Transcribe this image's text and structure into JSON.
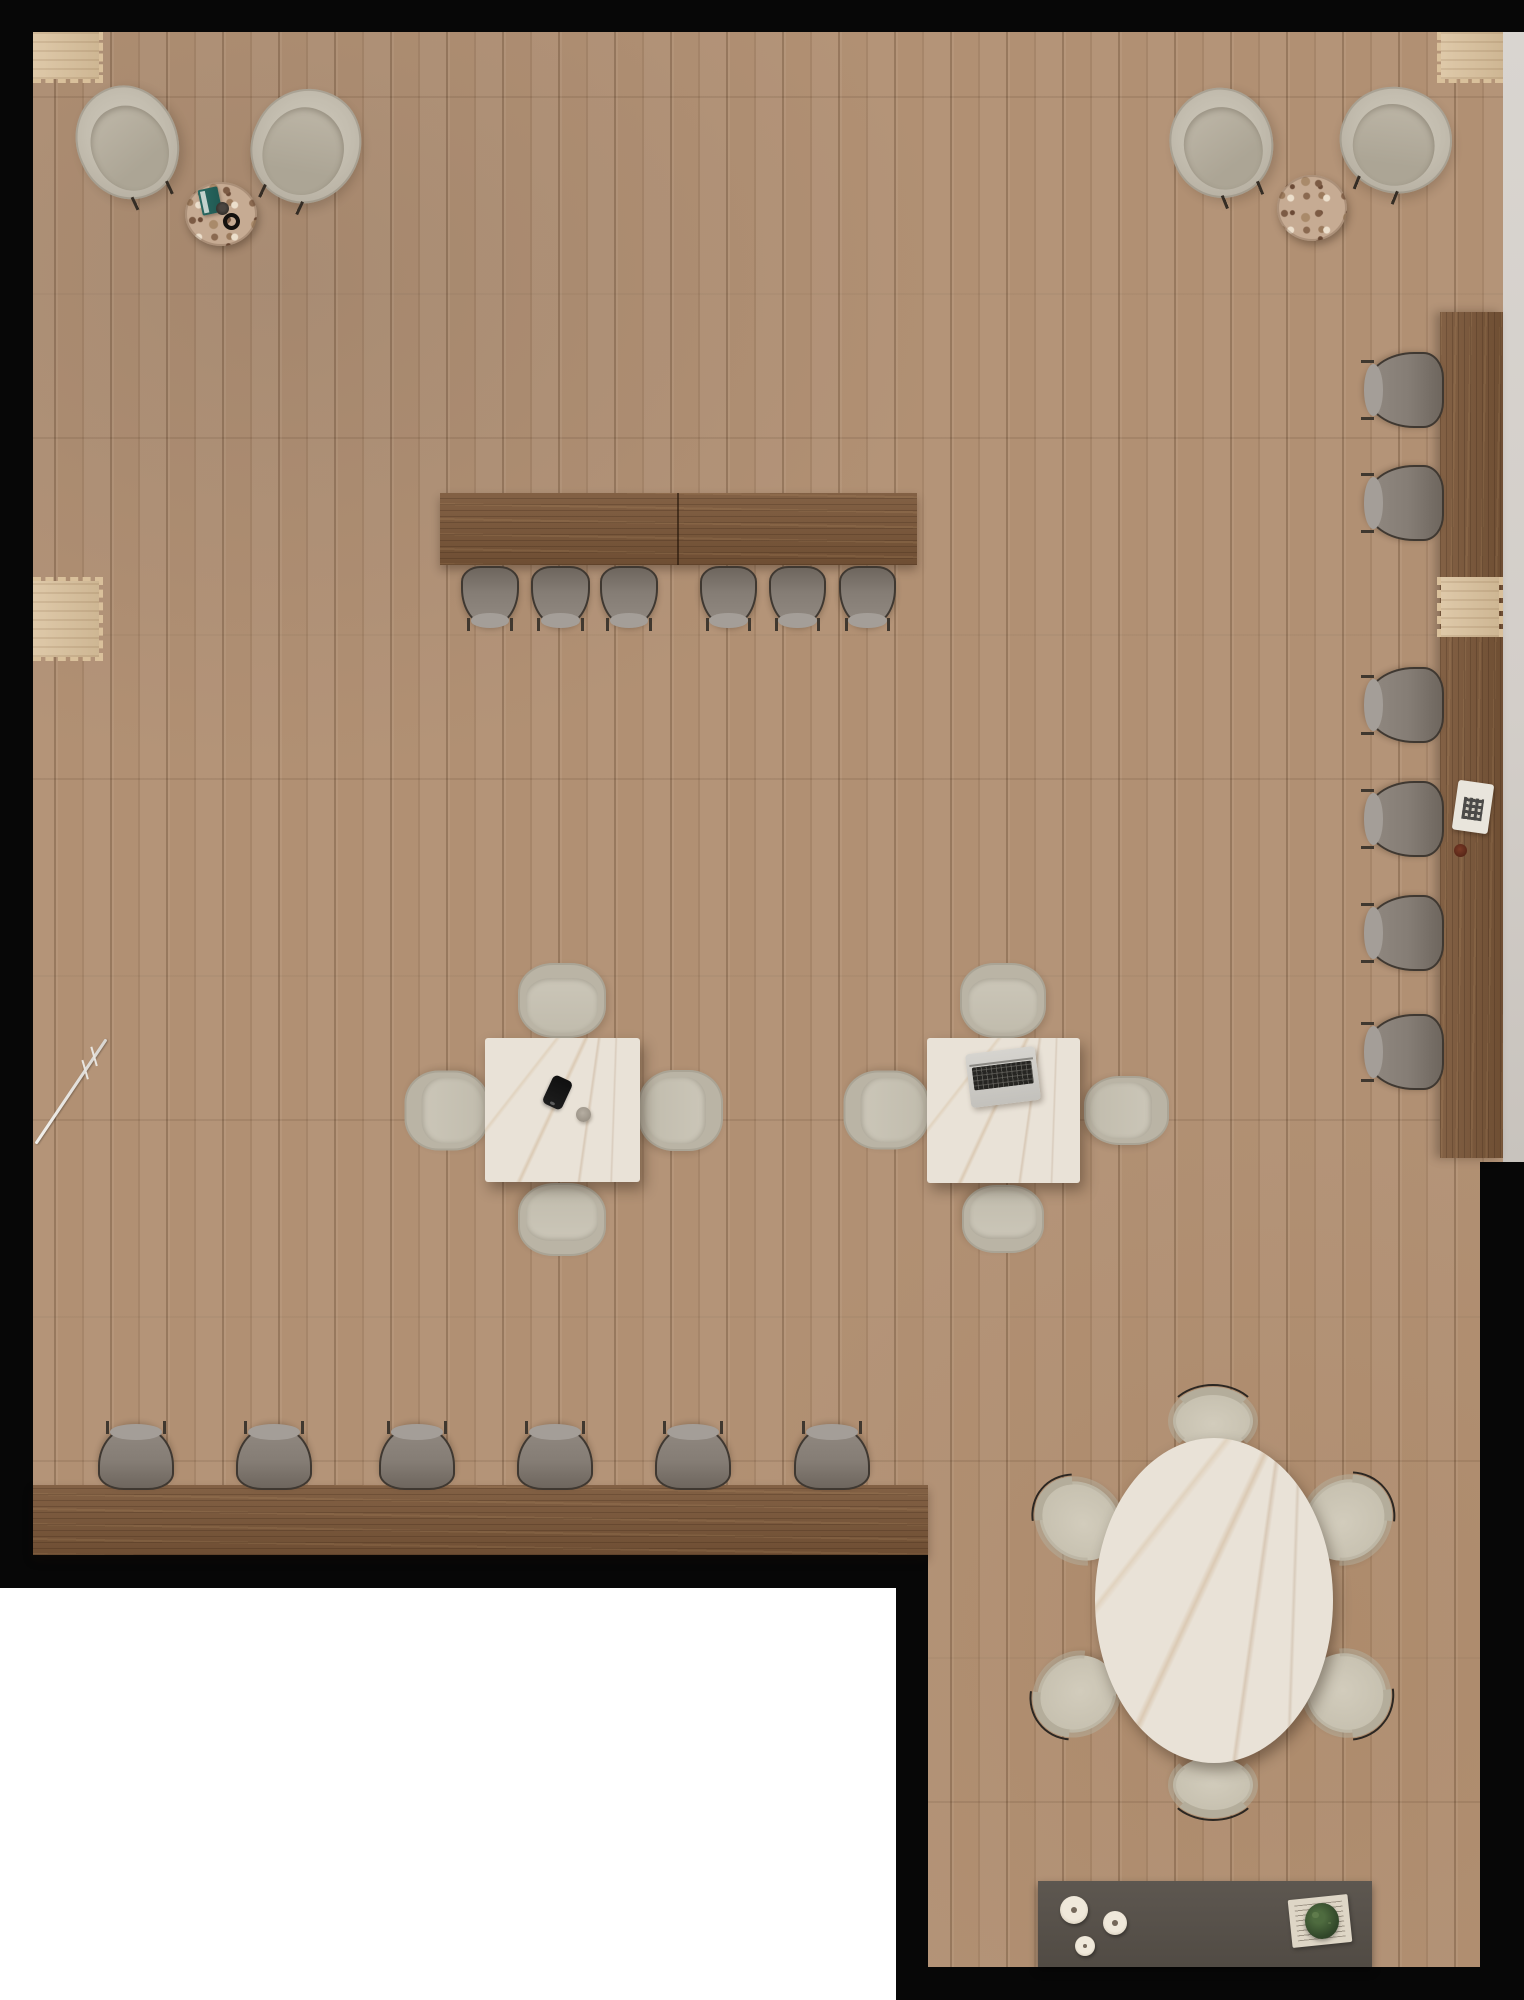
{
  "scene": {
    "description": "top-down 3d render of cafe coworking floor plan",
    "canvas": {
      "w": 1524,
      "h": 2000
    },
    "palette": {
      "background_black": "#070707",
      "floor_oak": "#b19073",
      "plank_seam": "#5e3f24",
      "counter_wood": "#7b5739",
      "inset_wood": "#d9c09b",
      "wall_gray": "#d4cfca",
      "cutout_white": "#ffffff",
      "marble": "#e9e2d7",
      "marble_vein": "#b08a5e",
      "chair_gray_fabric": "#857d75",
      "chair_gray_frame": "#3f3831",
      "chair_beige": "#c3bdae",
      "lounge_beige": "#c4beb0",
      "terrazzo": "#c6ab93",
      "sideboard_gray": "#57514a",
      "plant_green": "#3a5230",
      "book_teal": "#27645d"
    },
    "objects": [
      {
        "type": "floor",
        "name": "wood-floor",
        "x": 0,
        "y": 0,
        "w": 1524,
        "h": 2000
      },
      {
        "type": "wall-strip",
        "name": "right-wall-ledge",
        "x": 1503,
        "y": 32,
        "w": 21,
        "h": 1130
      },
      {
        "type": "white-cutout",
        "name": "plan-cutout-area",
        "x": 0,
        "y": 1588,
        "w": 896,
        "h": 412
      },
      {
        "type": "inset-tl",
        "name": "wall-niche-top-left",
        "x": 33,
        "y": 32,
        "w": 70,
        "h": 51
      },
      {
        "type": "inset-tr",
        "name": "wall-niche-top-right",
        "x": 1437,
        "y": 32,
        "w": 66,
        "h": 51
      },
      {
        "type": "inset-left",
        "name": "wall-niche-left",
        "x": 33,
        "y": 577,
        "w": 70,
        "h": 84
      },
      {
        "type": "stand-line",
        "name": "floor-lamp-stand",
        "x": 8,
        "y": 1090,
        "w": 126,
        "h": 3,
        "rot": -56
      },
      {
        "type": "lounge-chair",
        "name": "lounge-chair",
        "x": 77,
        "y": 85,
        "w": 101,
        "h": 115,
        "rot": -25
      },
      {
        "type": "lounge-chair",
        "name": "lounge-chair",
        "x": 252,
        "y": 88,
        "w": 108,
        "h": 116,
        "rot": 25
      },
      {
        "type": "table-terrazzo",
        "name": "terrazzo-side-table",
        "x": 185,
        "y": 182,
        "w": 72,
        "h": 64
      },
      {
        "type": "book-teal",
        "name": "book",
        "x": 200,
        "y": 188,
        "w": 20,
        "h": 26,
        "rot": -12
      },
      {
        "type": "cup-black",
        "name": "espresso-cup",
        "x": 216,
        "y": 202,
        "w": 13,
        "h": 13
      },
      {
        "type": "ring-black",
        "name": "coaster-ring",
        "x": 223,
        "y": 213,
        "w": 17,
        "h": 17
      },
      {
        "type": "lounge-chair",
        "name": "lounge-chair",
        "x": 1170,
        "y": 88,
        "w": 103,
        "h": 110,
        "rot": -22
      },
      {
        "type": "lounge-chair",
        "name": "lounge-chair",
        "x": 1340,
        "y": 87,
        "w": 112,
        "h": 106,
        "rot": 22
      },
      {
        "type": "table-terrazzo",
        "name": "terrazzo-side-table",
        "x": 1277,
        "y": 175,
        "w": 70,
        "h": 66
      },
      {
        "type": "counter-top",
        "name": "long-counter-table",
        "x": 440,
        "y": 493,
        "w": 477,
        "h": 72
      },
      {
        "type": "seam-v",
        "name": "counter-seam",
        "x": 677,
        "y": 493,
        "w": 2,
        "h": 72
      },
      {
        "type": "chair-gray",
        "name": "counter-chair",
        "x": 461,
        "y": 566,
        "w": 58,
        "h": 60
      },
      {
        "type": "chair-gray",
        "name": "counter-chair",
        "x": 531,
        "y": 566,
        "w": 59,
        "h": 60
      },
      {
        "type": "chair-gray",
        "name": "counter-chair",
        "x": 600,
        "y": 566,
        "w": 58,
        "h": 60
      },
      {
        "type": "chair-gray",
        "name": "counter-chair",
        "x": 700,
        "y": 566,
        "w": 57,
        "h": 60
      },
      {
        "type": "chair-gray",
        "name": "counter-chair",
        "x": 769,
        "y": 566,
        "w": 57,
        "h": 60
      },
      {
        "type": "chair-gray",
        "name": "counter-chair",
        "x": 839,
        "y": 566,
        "w": 57,
        "h": 60
      },
      {
        "type": "bar-right",
        "name": "wall-bar-counter",
        "x": 1440,
        "y": 312,
        "w": 63,
        "h": 846
      },
      {
        "type": "inset-bar",
        "name": "bar-pass-through",
        "x": 1437,
        "y": 577,
        "w": 66,
        "h": 60
      },
      {
        "type": "chair-gray",
        "name": "bar-chair",
        "x": 1367,
        "y": 351,
        "w": 76,
        "h": 78,
        "rot": 90
      },
      {
        "type": "chair-gray",
        "name": "bar-chair",
        "x": 1367,
        "y": 464,
        "w": 76,
        "h": 78,
        "rot": 90
      },
      {
        "type": "chair-gray",
        "name": "bar-chair",
        "x": 1367,
        "y": 666,
        "w": 76,
        "h": 78,
        "rot": 90
      },
      {
        "type": "chair-gray",
        "name": "bar-chair",
        "x": 1367,
        "y": 780,
        "w": 76,
        "h": 78,
        "rot": 90
      },
      {
        "type": "chair-gray",
        "name": "bar-chair",
        "x": 1367,
        "y": 894,
        "w": 76,
        "h": 78,
        "rot": 90
      },
      {
        "type": "chair-gray",
        "name": "bar-chair",
        "x": 1367,
        "y": 1013,
        "w": 76,
        "h": 78,
        "rot": 90
      },
      {
        "type": "tablet-qr",
        "name": "qr-menu-card",
        "x": 1455,
        "y": 782,
        "w": 36,
        "h": 50,
        "rot": 8
      },
      {
        "type": "candle-dark",
        "name": "candle",
        "x": 1454,
        "y": 844,
        "w": 13,
        "h": 13
      },
      {
        "type": "chair-beige",
        "name": "dining-chair",
        "x": 518,
        "y": 963,
        "w": 88,
        "h": 75
      },
      {
        "type": "chair-beige",
        "name": "dining-chair",
        "x": 407,
        "y": 1068,
        "w": 80,
        "h": 85,
        "rot": -90
      },
      {
        "type": "chair-beige",
        "name": "dining-chair",
        "x": 640,
        "y": 1068,
        "w": 81,
        "h": 85,
        "rot": 90
      },
      {
        "type": "chair-beige",
        "name": "dining-chair",
        "x": 518,
        "y": 1183,
        "w": 88,
        "h": 73,
        "rot": 180
      },
      {
        "type": "table-marble",
        "name": "square-marble-table",
        "x": 485,
        "y": 1038,
        "w": 155,
        "h": 144
      },
      {
        "type": "phone",
        "name": "smartphone",
        "x": 547,
        "y": 1077,
        "w": 21,
        "h": 31,
        "rot": 25
      },
      {
        "type": "cup-gray",
        "name": "cup",
        "x": 576,
        "y": 1107,
        "w": 15,
        "h": 15
      },
      {
        "type": "chair-beige",
        "name": "dining-chair",
        "x": 960,
        "y": 963,
        "w": 86,
        "h": 75
      },
      {
        "type": "chair-beige",
        "name": "dining-chair",
        "x": 847,
        "y": 1067,
        "w": 79,
        "h": 86,
        "rot": -90
      },
      {
        "type": "chair-beige",
        "name": "dining-chair",
        "x": 1092,
        "y": 1068,
        "w": 69,
        "h": 85,
        "rot": 90
      },
      {
        "type": "chair-beige",
        "name": "dining-chair",
        "x": 962,
        "y": 1185,
        "w": 82,
        "h": 68,
        "rot": 180
      },
      {
        "type": "table-marble",
        "name": "square-marble-table",
        "x": 927,
        "y": 1038,
        "w": 153,
        "h": 145
      },
      {
        "type": "laptop",
        "name": "laptop",
        "x": 968,
        "y": 1050,
        "w": 70,
        "h": 54,
        "rot": -7
      },
      {
        "type": "counter-bottom",
        "name": "window-counter",
        "x": 33,
        "y": 1485,
        "w": 895,
        "h": 70
      },
      {
        "type": "chair-gray",
        "name": "counter-chair",
        "x": 98,
        "y": 1426,
        "w": 76,
        "h": 64,
        "rot": 180
      },
      {
        "type": "chair-gray",
        "name": "counter-chair",
        "x": 236,
        "y": 1426,
        "w": 76,
        "h": 64,
        "rot": 180
      },
      {
        "type": "chair-gray",
        "name": "counter-chair",
        "x": 379,
        "y": 1426,
        "w": 76,
        "h": 64,
        "rot": 180
      },
      {
        "type": "chair-gray",
        "name": "counter-chair",
        "x": 517,
        "y": 1426,
        "w": 76,
        "h": 64,
        "rot": 180
      },
      {
        "type": "chair-gray",
        "name": "counter-chair",
        "x": 655,
        "y": 1426,
        "w": 76,
        "h": 64,
        "rot": 180
      },
      {
        "type": "chair-gray",
        "name": "counter-chair",
        "x": 794,
        "y": 1426,
        "w": 76,
        "h": 64,
        "rot": 180
      },
      {
        "type": "pouf",
        "name": "round-dining-chair",
        "x": 1173,
        "y": 1392,
        "w": 80,
        "h": 58
      },
      {
        "type": "pouf",
        "name": "round-dining-chair",
        "x": 1043,
        "y": 1478,
        "w": 74,
        "h": 86,
        "rot": -50
      },
      {
        "type": "pouf",
        "name": "round-dining-chair",
        "x": 1307,
        "y": 1477,
        "w": 78,
        "h": 86,
        "rot": 50
      },
      {
        "type": "pouf",
        "name": "round-dining-chair",
        "x": 1040,
        "y": 1653,
        "w": 74,
        "h": 82,
        "rot": -128
      },
      {
        "type": "pouf",
        "name": "round-dining-chair",
        "x": 1307,
        "y": 1652,
        "w": 78,
        "h": 82,
        "rot": 128
      },
      {
        "type": "pouf",
        "name": "round-dining-chair",
        "x": 1173,
        "y": 1757,
        "w": 80,
        "h": 56,
        "rot": 180
      },
      {
        "type": "table-oval",
        "name": "oval-marble-table",
        "x": 1095,
        "y": 1438,
        "w": 238,
        "h": 325
      },
      {
        "type": "sideboard",
        "name": "service-sideboard",
        "x": 1038,
        "y": 1881,
        "w": 334,
        "h": 86
      },
      {
        "type": "plate",
        "name": "plate",
        "x": 1060,
        "y": 1896,
        "w": 28,
        "h": 28
      },
      {
        "type": "plate",
        "name": "plate",
        "x": 1103,
        "y": 1911,
        "w": 24,
        "h": 24
      },
      {
        "type": "plate",
        "name": "plate",
        "x": 1075,
        "y": 1936,
        "w": 20,
        "h": 20
      },
      {
        "type": "newspaper",
        "name": "newspaper",
        "x": 1290,
        "y": 1897,
        "w": 60,
        "h": 48,
        "rot": -6
      },
      {
        "type": "plant",
        "name": "potted-plant",
        "x": 1305,
        "y": 1903,
        "w": 34,
        "h": 36
      }
    ]
  }
}
